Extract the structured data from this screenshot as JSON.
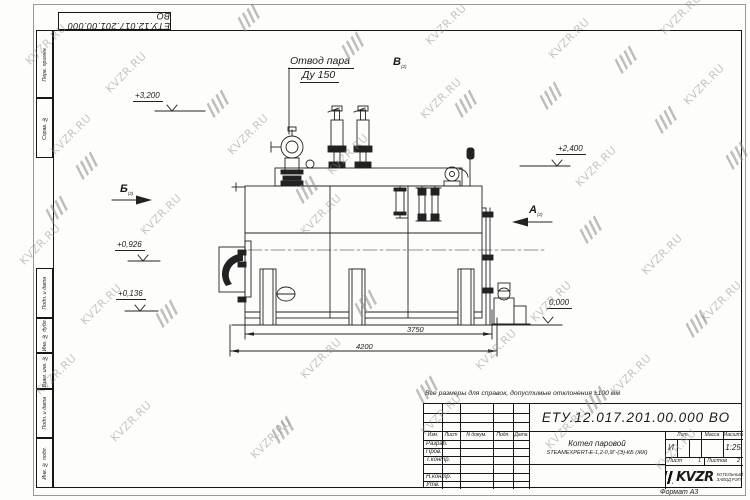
{
  "doc_number": "ЕТУ.12.017.201.00.000 ВО",
  "watermark": {
    "text": "KVZR.RU"
  },
  "sheet": {
    "note": "Все размеры для справок, допустимые отклонения ±100 мм",
    "format_label": "Формат А3",
    "left_strip": [
      "Перв. примен.",
      "Справ. №",
      "Подп. и дата",
      "Инв. № дубл.",
      "Взам. инв. №",
      "Подп. и дата",
      "Инв. № подл."
    ]
  },
  "annotations": {
    "steam_outlet_line1": "Отвод пара",
    "steam_outlet_line2": "Ду 150",
    "view_b": "Б",
    "view_b_sub": "(2)",
    "view_a": "А",
    "view_a_sub": "(2)",
    "view_v": "В",
    "view_v_sub": "(2)",
    "elev_3200": "+3,200",
    "elev_2400": "+2,400",
    "elev_0926": "+0,926",
    "elev_0136": "+0,136",
    "elev_0000": "0,000",
    "dim_3750": "3750",
    "dim_4200": "4200"
  },
  "title_block": {
    "name_line1": "Котел паровой",
    "name_line2": "STEAMEXPERT-Е-1,2-0,9Г-(Э)-КБ (ЖК)",
    "header_cols": [
      "Изм.",
      "Лист",
      "N докум.",
      "Подп.",
      "Дата"
    ],
    "rows": [
      "Разраб.",
      "Пров.",
      "Т.контр.",
      "Н.контр.",
      "Утв."
    ],
    "lit_label": "Лит.",
    "lit_value": "И",
    "mass_label": "Масса",
    "scale_label": "Масштаб",
    "scale_value": "1:25",
    "sheet_label": "Лист",
    "sheet_value": "1",
    "sheets_label": "Листов",
    "sheets_value": "2",
    "company": "KVZR",
    "company_sub1": "КОТЕЛЬНЫЙ",
    "company_sub2": "ЗАВОД РЭП"
  }
}
